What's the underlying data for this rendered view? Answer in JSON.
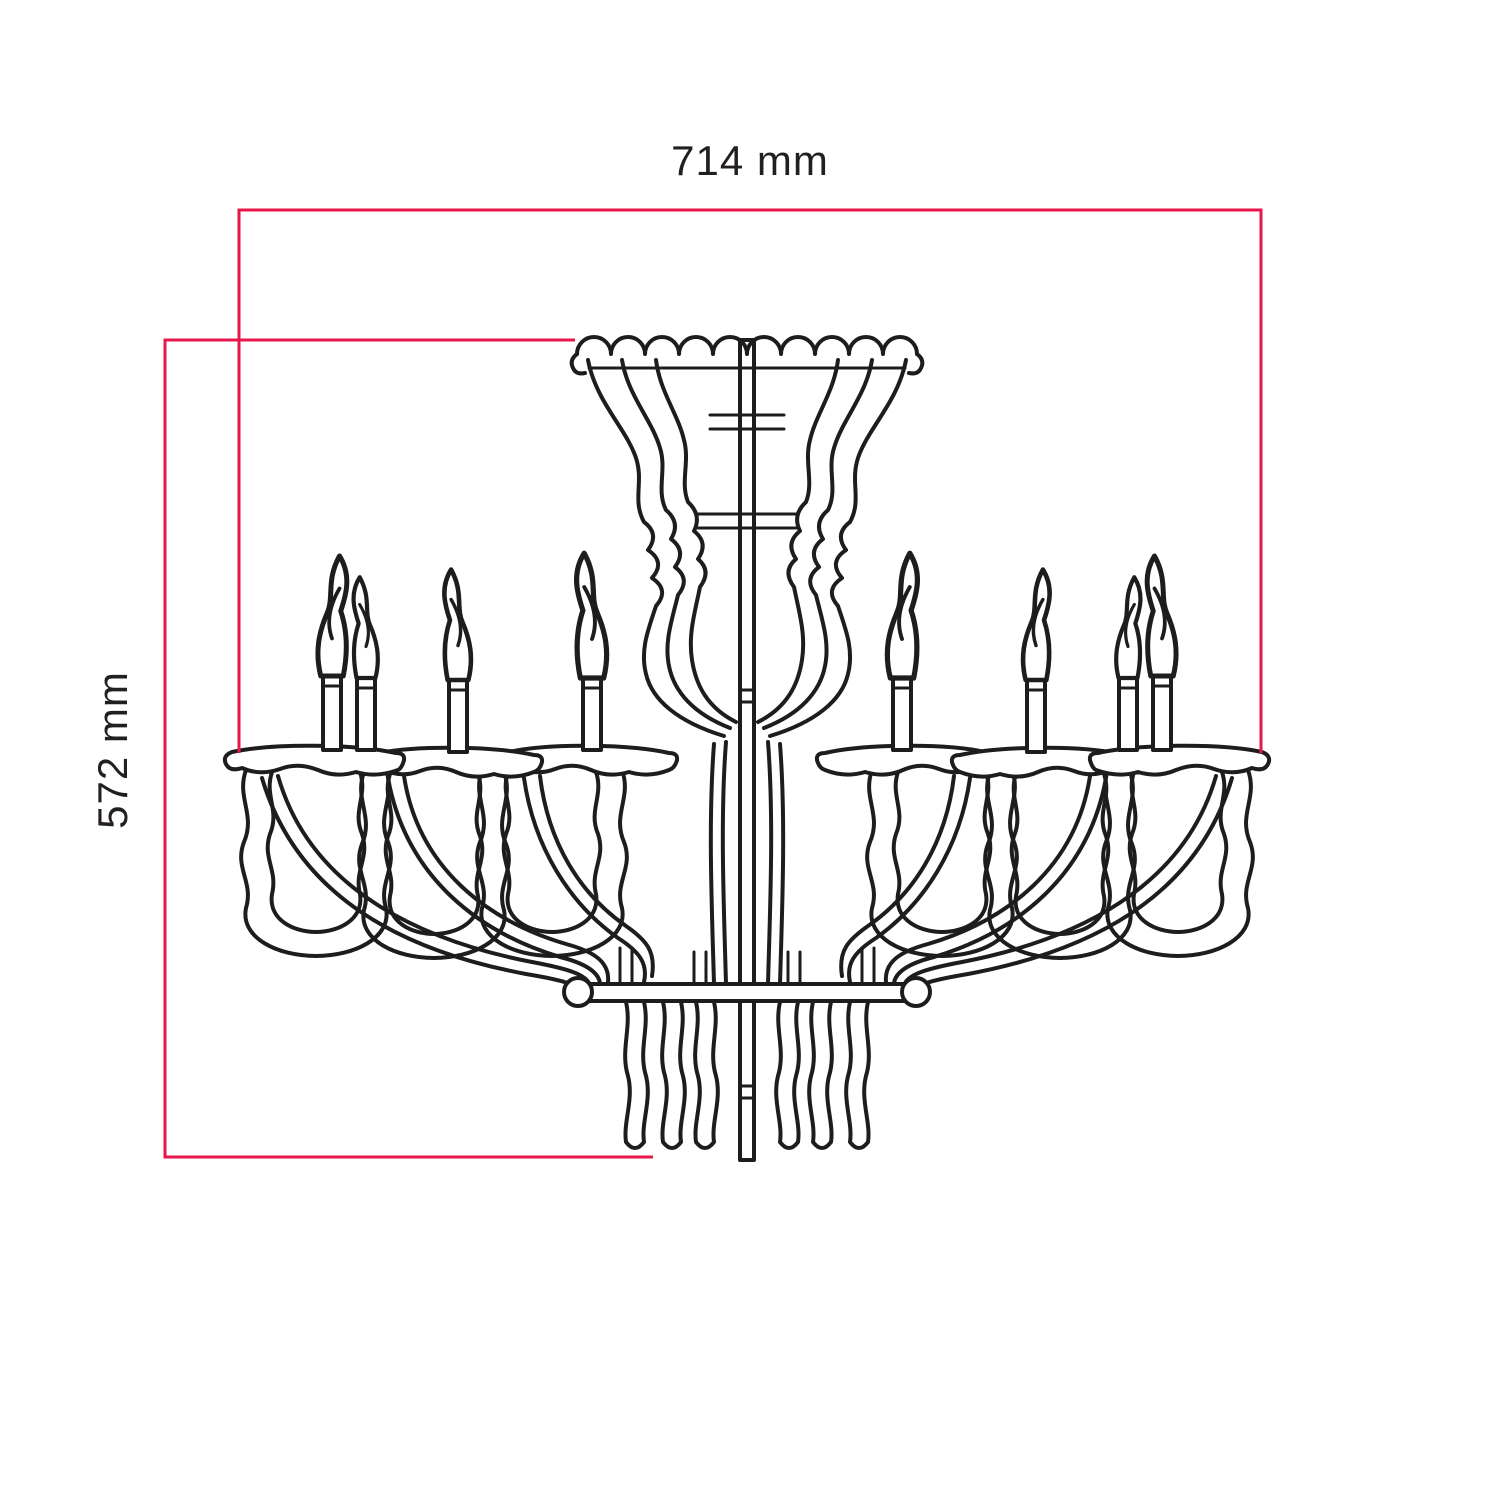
{
  "colors": {
    "background": "#ffffff",
    "line": "#1d1d1b",
    "dimension": "#e8174b",
    "text": "#231f20"
  },
  "drawing": {
    "dimensions": {
      "width": {
        "label": "714 mm"
      },
      "height": {
        "label": "572 mm"
      }
    }
  }
}
